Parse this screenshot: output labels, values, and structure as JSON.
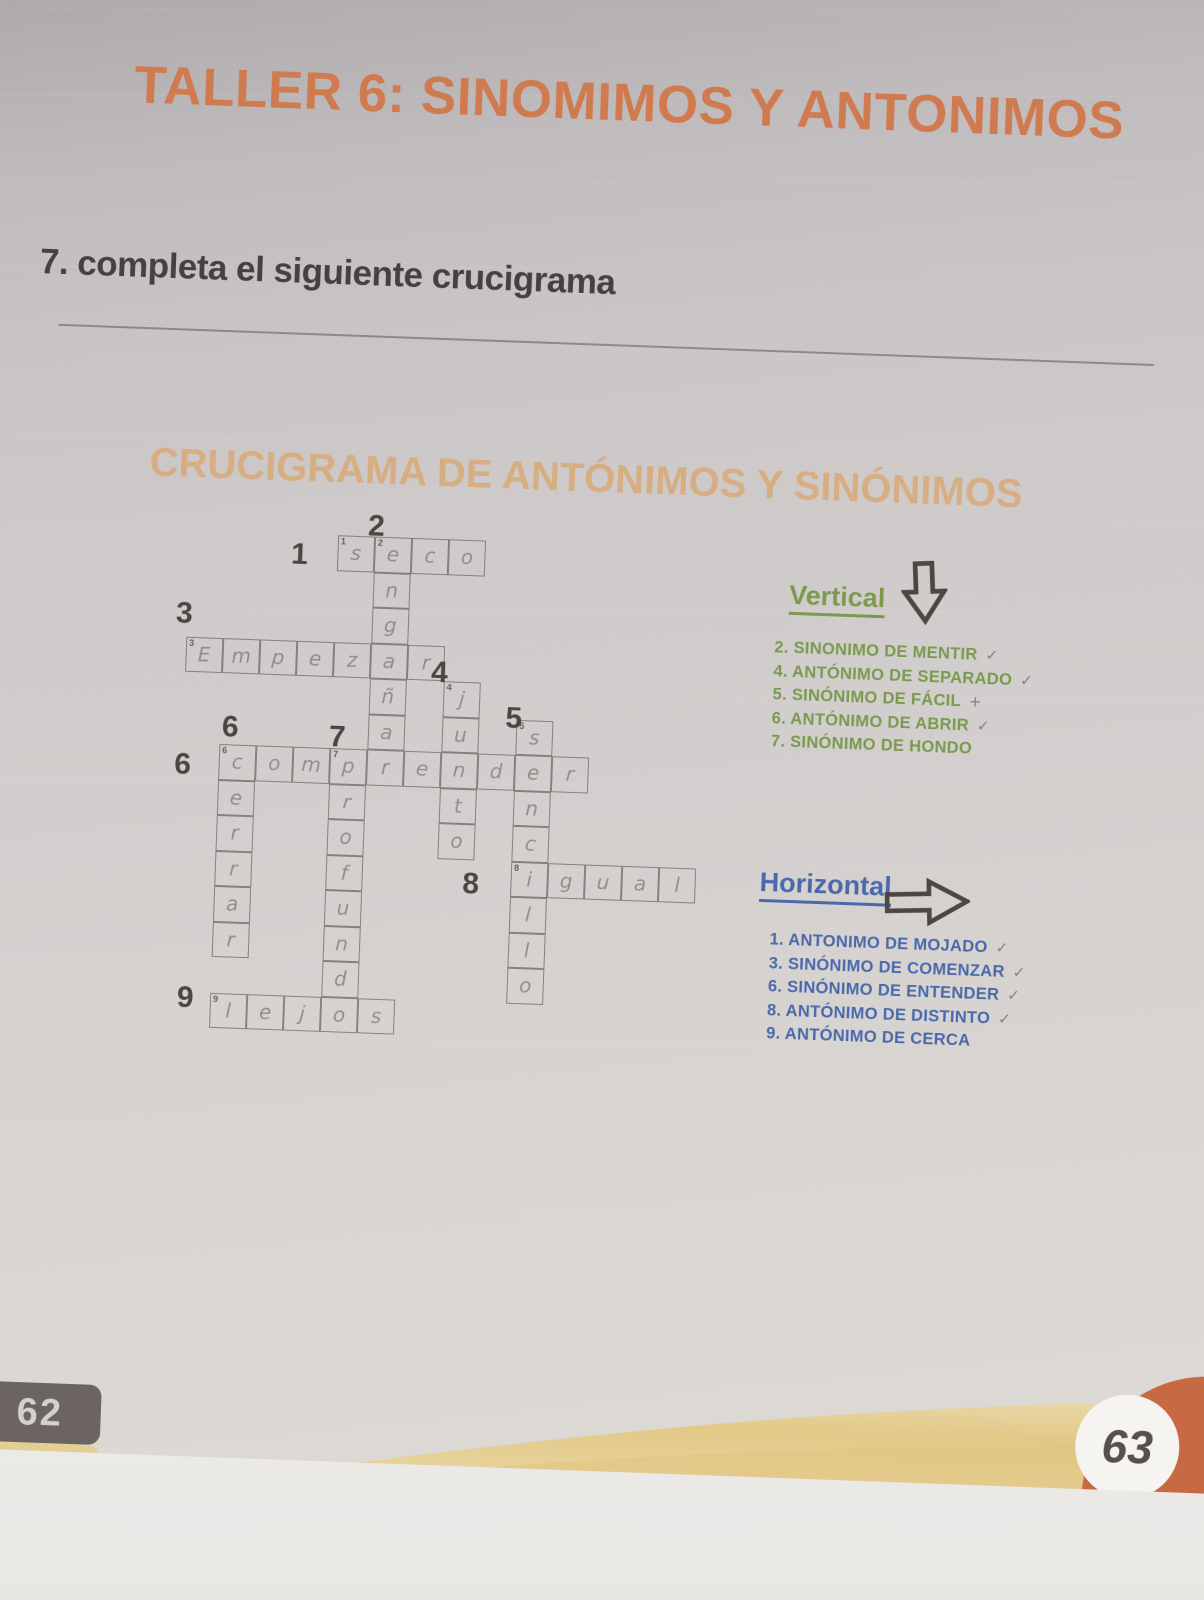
{
  "page": {
    "title": "TALLER 6: SINOMIMOS Y ANTONIMOS",
    "exercise_instruction": "7. completa el siguiente crucigrama",
    "page_number_left": "62",
    "page_number_right": "63"
  },
  "colors": {
    "title_orange": "#d07a4f",
    "heading_tan": "#d8ab7c",
    "text_dark": "#454140",
    "vertical_green": "#7a9a4e",
    "horizontal_blue": "#4a69ac",
    "pencil_gray": "#84807e",
    "label_dark": "#4b4644",
    "badge_dark": "#6b6462",
    "corner_orange": "#c76a43",
    "accent_yellow": "#e5cc8a"
  },
  "crossword": {
    "title": "CRUCIGRAMA DE  ANTÓNIMOS Y SINÓNIMOS",
    "words": [
      {
        "num": "1",
        "dir": "across",
        "row": 0,
        "col": 4,
        "answer": "seco"
      },
      {
        "num": "2",
        "dir": "down",
        "row": 0,
        "col": 5,
        "answer": "engañar"
      },
      {
        "num": "3",
        "dir": "across",
        "row": 3,
        "col": 0,
        "answer": "Empezar"
      },
      {
        "num": "4",
        "dir": "down",
        "row": 4,
        "col": 7,
        "answer": "junto"
      },
      {
        "num": "5",
        "dir": "down",
        "row": 5,
        "col": 9,
        "answer": "sencillo"
      },
      {
        "num": "6",
        "dir": "across",
        "row": 6,
        "col": 1,
        "answer": "comprender"
      },
      {
        "num": "6",
        "dir": "down",
        "row": 6,
        "col": 1,
        "answer": "cerrar"
      },
      {
        "num": "7",
        "dir": "down",
        "row": 6,
        "col": 4,
        "answer": "profundo"
      },
      {
        "num": "8",
        "dir": "across",
        "row": 9,
        "col": 9,
        "answer": "igual"
      },
      {
        "num": "9",
        "dir": "across",
        "row": 13,
        "col": 1,
        "answer": "lejos"
      }
    ],
    "number_labels": [
      {
        "num": "1",
        "col": 2.75,
        "row": 0.1
      },
      {
        "num": "2",
        "col": 4.8,
        "row": -0.75
      },
      {
        "num": "3",
        "col": -0.3,
        "row": 1.9
      },
      {
        "num": "4",
        "col": 6.65,
        "row": 3.3
      },
      {
        "num": "5",
        "col": 8.7,
        "row": 4.5
      },
      {
        "num": "6",
        "col": 1.05,
        "row": 5.05
      },
      {
        "num": "6",
        "col": -0.2,
        "row": 6.15
      },
      {
        "num": "7",
        "col": 3.95,
        "row": 5.2
      },
      {
        "num": "8",
        "col": 7.7,
        "row": 9.2
      },
      {
        "num": "9",
        "col": 0.1,
        "row": 12.7
      }
    ]
  },
  "vertical": {
    "heading": "Vertical",
    "icon": "down-arrow",
    "clues": [
      {
        "num": "2.",
        "text": "SINONIMO DE MENTIR",
        "mark": "✓"
      },
      {
        "num": "4.",
        "text": "ANTÓNIMO DE SEPARADO",
        "mark": "✓"
      },
      {
        "num": "5.",
        "text": "SINÓNIMO DE FÁCIL",
        "mark": "+"
      },
      {
        "num": "6.",
        "text": "ANTÓNIMO DE ABRIR",
        "mark": "✓"
      },
      {
        "num": "7.",
        "text": "SINÓNIMO DE HONDO",
        "mark": ""
      }
    ]
  },
  "horizontal": {
    "heading": "Horizontal",
    "icon": "right-arrow",
    "clues": [
      {
        "num": "1.",
        "text": "ANTONIMO DE MOJADO",
        "mark": "✓"
      },
      {
        "num": "3.",
        "text": "SINÓNIMO DE COMENZAR",
        "mark": "✓"
      },
      {
        "num": "6.",
        "text": "SINÓNIMO DE ENTENDER",
        "mark": "✓"
      },
      {
        "num": "8.",
        "text": "ANTÓNIMO DE DISTINTO",
        "mark": "✓"
      },
      {
        "num": "9.",
        "text": "ANTÓNIMO DE CERCA",
        "mark": ""
      }
    ]
  }
}
